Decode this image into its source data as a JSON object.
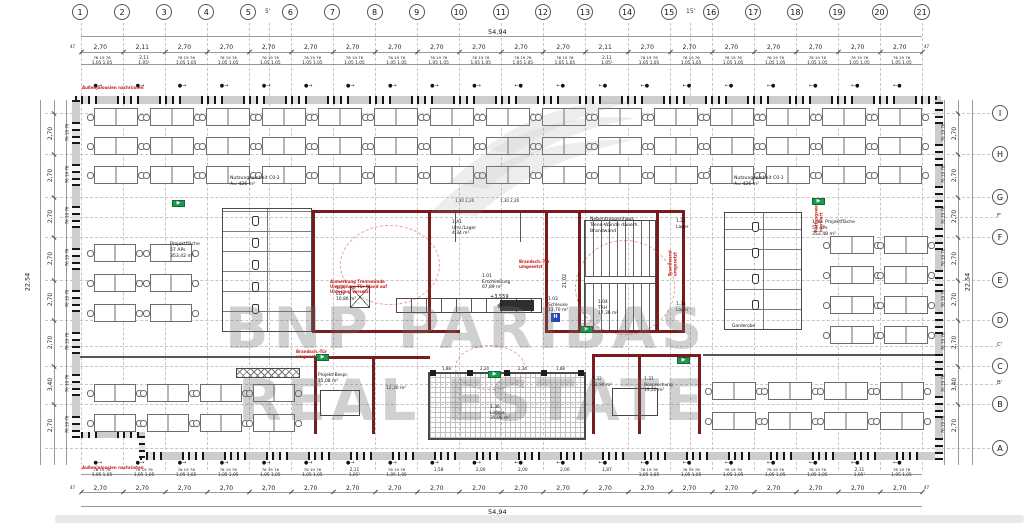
{
  "watermark": {
    "line1": "BNP PARIBAS",
    "line2": "REAL ESTATE"
  },
  "grid": {
    "columns": [
      "1",
      "2",
      "3",
      "4",
      "5",
      "6",
      "7",
      "8",
      "9",
      "10",
      "11",
      "12",
      "13",
      "14",
      "15",
      "16",
      "17",
      "18",
      "19",
      "20",
      "21"
    ],
    "column_intermediates": [
      {
        "label": "5'",
        "x": 269
      },
      {
        "label": "15'",
        "x": 690
      }
    ],
    "rows": [
      {
        "label": "I",
        "y": 113
      },
      {
        "label": "H",
        "y": 154
      },
      {
        "label": "G",
        "y": 197
      },
      {
        "label": "F",
        "y": 237
      },
      {
        "label": "E",
        "y": 280
      },
      {
        "label": "D",
        "y": 320
      },
      {
        "label": "C",
        "y": 366
      },
      {
        "label": "B",
        "y": 404
      },
      {
        "label": "A",
        "y": 448
      }
    ],
    "row_intermediates": [
      {
        "label": "F'",
        "y": 217
      },
      {
        "label": "C'",
        "y": 346
      },
      {
        "label": "B'",
        "y": 384
      }
    ]
  },
  "dimensions": {
    "total_width": "54,94",
    "total_height": "22,54",
    "bay_width": "2,70",
    "special_bay": "2,11",
    "special_sub": "1,05¹",
    "end_offset": "47",
    "sub_line1": "76 19 76",
    "sub_line2": "1,05   1,05",
    "top_special_bays": [
      1,
      12
    ],
    "bottom_special_bays": [
      6,
      18
    ],
    "loggia_bays_start": 8,
    "loggia_bay_values": [
      "1,58",
      "2,00",
      "2,00",
      "2,00",
      "1,87"
    ],
    "side_bays": [
      "2,70",
      "2,70",
      "2,70",
      "2,70",
      "2,70",
      "2,70",
      "3,40",
      "2,70"
    ],
    "dim_27_05": "27,05",
    "dim_21_02": "21,02",
    "level_mark": "+3,559",
    "core_top_dims": "1,30  2,26",
    "loggia_top_dims": [
      "1,88",
      "2,24",
      "2,24",
      "1,88"
    ]
  },
  "rooms": [
    {
      "id": "1.27",
      "name": "EDV",
      "area": "10,86 m²",
      "x": 336,
      "y": 286
    },
    {
      "id": "1.01",
      "name": "Erschließung",
      "area": "67,89 m²",
      "x": 482,
      "y": 274
    },
    {
      "id": "1.03",
      "name": "Schleuse",
      "area": "13,70 m²",
      "x": 548,
      "y": 297
    },
    {
      "id": "1.04",
      "name": "TRH",
      "area": "17,36 m²",
      "x": 598,
      "y": 300
    },
    {
      "id": "1.A1",
      "name": "Uml./Lager",
      "area": "4,34 m²",
      "x": 452,
      "y": 220
    },
    {
      "id": "1.36",
      "name": "Loggia",
      "area": "35,06 m²",
      "x": 490,
      "y": 405
    },
    {
      "id": "1.21",
      "name": "Lager",
      "area": "",
      "x": 676,
      "y": 219
    },
    {
      "id": "1.34",
      "name": "Lager",
      "area": "",
      "x": 676,
      "y": 302
    },
    {
      "id": "",
      "name": "Garderobe",
      "area": "",
      "x": 732,
      "y": 324
    },
    {
      "id": "1.31",
      "name": "Besprechung",
      "area": "19,20 m²",
      "x": 644,
      "y": 377
    },
    {
      "id": "1.32",
      "name": "",
      "area": "12,90 m²",
      "x": 592,
      "y": 377
    },
    {
      "id": "",
      "name": "Projekt-Bespr.",
      "area": "15,08 m²",
      "x": 318,
      "y": 373
    },
    {
      "id": "",
      "name": "",
      "area": "12,30 m²",
      "x": 386,
      "y": 386
    }
  ],
  "area_labels": [
    {
      "lines": "Nutzungseinheit C0-2\nA= 426 m²",
      "x": 230,
      "y": 176
    },
    {
      "lines": "Nutzungseinheit C0-1\nA= 426 m²",
      "x": 734,
      "y": 176
    },
    {
      "lines": "Projektfläche\n57 APs\n353,42 m²",
      "x": 170,
      "y": 242
    },
    {
      "lines": "1.30  Projektfläche\n57 APs\n352,48 m²",
      "x": 812,
      "y": 220
    },
    {
      "lines": "Nebentreppenhaus\nTrenn-Wände dauerh.\nBrandwand",
      "x": 590,
      "y": 217
    }
  ],
  "red_annotations": [
    {
      "text": "Außenjalousien nachrüsten",
      "x": 82,
      "y": 85,
      "rot": 0
    },
    {
      "text": "Außenjalousien nachrüsten",
      "x": 82,
      "y": 465,
      "rot": 0
    },
    {
      "text": "Anmerkung Trennwände\nUmplanung TS: Wand auf\nUnterzug versetzt",
      "x": 330,
      "y": 279,
      "rot": 0
    },
    {
      "text": "Brandsch.-Tür\numgesetzt",
      "x": 519,
      "y": 259,
      "rot": 0
    },
    {
      "text": "Brandsch.-Tür\numgesetzt",
      "x": 296,
      "y": 349,
      "rot": 0
    },
    {
      "text": "Brandwand\numgesetzt",
      "x": 660,
      "y": 258,
      "rot": 90
    },
    {
      "text": "Rettungsweg\nmarkiert",
      "x": 804,
      "y": 212,
      "rot": 90
    }
  ],
  "exit_signs": [
    [
      172,
      200
    ],
    [
      316,
      354
    ],
    [
      488,
      371
    ],
    [
      580,
      326
    ],
    [
      812,
      198
    ],
    [
      677,
      357
    ]
  ],
  "hydrant": {
    "label": "H",
    "x": 551,
    "y": 313
  },
  "desk_zones": [
    {
      "x": 94,
      "y": 108,
      "cols": 15,
      "rows": 3,
      "dx": 56,
      "dy": 29,
      "w": 44,
      "h": 18
    },
    {
      "x": 94,
      "y": 244,
      "cols": 2,
      "rows": 3,
      "dx": 56,
      "dy": 30,
      "w": 42,
      "h": 18
    },
    {
      "x": 94,
      "y": 384,
      "cols": 4,
      "rows": 2,
      "dx": 53,
      "dy": 30,
      "w": 42,
      "h": 18
    },
    {
      "x": 830,
      "y": 236,
      "cols": 2,
      "rows": 4,
      "dx": 54,
      "dy": 30,
      "w": 44,
      "h": 18
    },
    {
      "x": 712,
      "y": 382,
      "cols": 4,
      "rows": 2,
      "dx": 56,
      "dy": 30,
      "w": 44,
      "h": 18
    }
  ],
  "fire_walls": [
    [
      312,
      210,
      373,
      3
    ],
    [
      312,
      210,
      3,
      123
    ],
    [
      682,
      210,
      3,
      123
    ],
    [
      312,
      330,
      148,
      3
    ],
    [
      545,
      330,
      140,
      3
    ],
    [
      428,
      210,
      3,
      123
    ],
    [
      545,
      210,
      3,
      123
    ],
    [
      578,
      212,
      3,
      121
    ],
    [
      656,
      212,
      3,
      121
    ],
    [
      314,
      356,
      3,
      78
    ],
    [
      372,
      356,
      3,
      78
    ],
    [
      314,
      356,
      116,
      3
    ],
    [
      592,
      354,
      3,
      80
    ],
    [
      638,
      354,
      3,
      80
    ],
    [
      698,
      354,
      3,
      80
    ],
    [
      592,
      354,
      109,
      3
    ]
  ],
  "gray_lines": [
    [
      75,
      356,
      240,
      2
    ],
    [
      703,
      354,
      235,
      2
    ],
    [
      455,
      210,
      1,
      32
    ],
    [
      520,
      210,
      1,
      32
    ]
  ],
  "fixtures": [
    {
      "type": "wc",
      "x": 222,
      "y": 208,
      "w": 90,
      "h": 124
    },
    {
      "type": "wc",
      "x": 724,
      "y": 212,
      "w": 78,
      "h": 118
    },
    {
      "type": "loggia",
      "x": 428,
      "y": 372,
      "w": 158,
      "h": 68
    },
    {
      "type": "kitchen",
      "x": 396,
      "y": 298,
      "w": 146,
      "h": 15
    },
    {
      "type": "stair",
      "x": 584,
      "y": 220,
      "w": 72,
      "h": 112
    },
    {
      "type": "elev",
      "x": 350,
      "y": 286,
      "w": 20,
      "h": 22
    },
    {
      "type": "lockers",
      "x": 236,
      "y": 368,
      "w": 64,
      "h": 10
    },
    {
      "type": "table",
      "x": 320,
      "y": 390,
      "w": 40,
      "h": 26
    },
    {
      "type": "table",
      "x": 612,
      "y": 388,
      "w": 46,
      "h": 28
    }
  ],
  "wc_fixtures": [
    [
      252,
      216
    ],
    [
      252,
      238
    ],
    [
      252,
      260
    ],
    [
      252,
      282
    ],
    [
      252,
      304
    ],
    [
      752,
      222
    ],
    [
      752,
      248
    ],
    [
      752,
      274
    ],
    [
      752,
      300
    ]
  ],
  "loggia_columns_y": 370,
  "clouds": [
    [
      340,
      225,
      100,
      80
    ],
    [
      575,
      240,
      100,
      95
    ],
    [
      455,
      345,
      70,
      45
    ]
  ]
}
